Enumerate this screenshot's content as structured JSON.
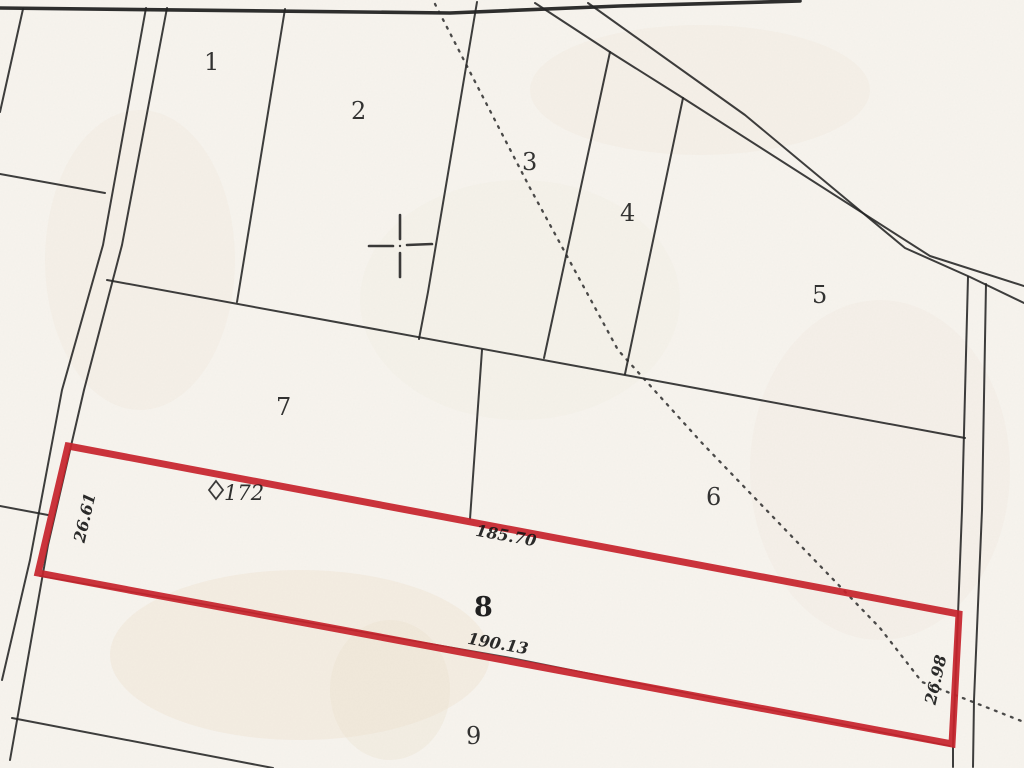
{
  "map": {
    "colors": {
      "paper": "#f7f4ee",
      "ink": "#232323",
      "highlight": "#c5232b"
    },
    "parcels": [
      {
        "label": "1"
      },
      {
        "label": "2"
      },
      {
        "label": "3"
      },
      {
        "label": "4"
      },
      {
        "label": "5"
      },
      {
        "label": "6"
      },
      {
        "label": "7"
      },
      {
        "label": "9"
      }
    ],
    "highlighted_parcel": {
      "label": "8",
      "marker_label": "172",
      "measurements": {
        "left_width": "26.61",
        "top_length": "185.70",
        "bottom_length": "190.13",
        "right_width": "26.98"
      }
    }
  }
}
